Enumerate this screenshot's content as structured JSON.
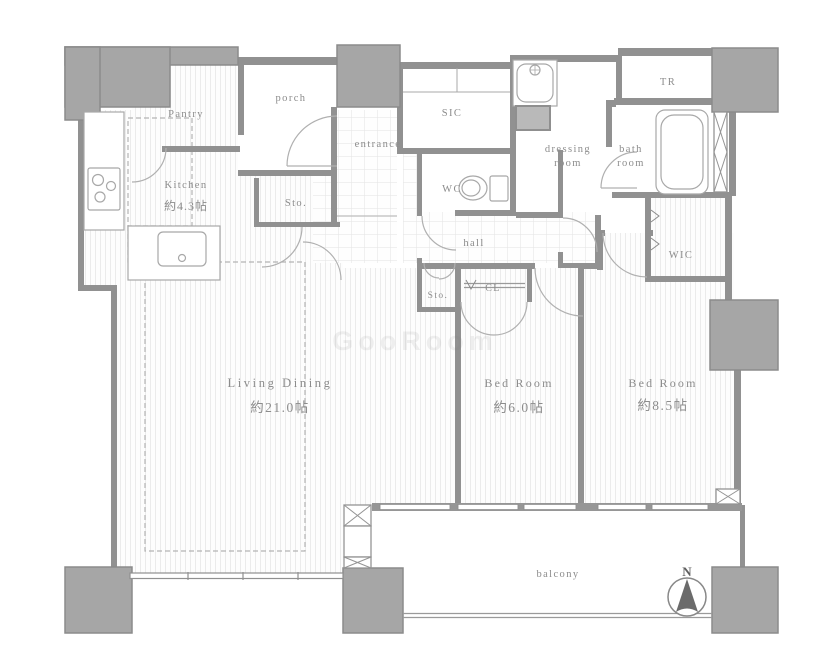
{
  "plan": {
    "rooms": {
      "pantry": {
        "label": "Pantry"
      },
      "porch": {
        "label": "porch"
      },
      "kitchen": {
        "label": "Kitchen",
        "area": "約4.3帖"
      },
      "sic": {
        "label": "SIC"
      },
      "entrance": {
        "label": "entrance"
      },
      "wc": {
        "label": "WC"
      },
      "dressing": {
        "l1": "dressing",
        "l2": "room"
      },
      "bath": {
        "l1": "bath",
        "l2": "room"
      },
      "tr": {
        "label": "TR"
      },
      "wic": {
        "label": "WIC"
      },
      "hall": {
        "label": "hall"
      },
      "sto_upper": {
        "label": "Sto."
      },
      "sto_lower": {
        "label": "Sto."
      },
      "cl": {
        "label": "CL"
      },
      "living": {
        "label": "Living Dining",
        "area": "約21.0帖"
      },
      "bed6": {
        "label": "Bed Room",
        "area": "約6.0帖"
      },
      "bed85": {
        "label": "Bed Room",
        "area": "約8.5帖"
      },
      "balcony": {
        "label": "balcony"
      }
    },
    "compass": {
      "label": "N"
    },
    "watermark": "GooRoom",
    "colors": {
      "wall": "#919191",
      "pillar": "#a6a6a6",
      "fixture_line": "#a8a8a8",
      "floor_hatch": "#ebebeb",
      "tile_line": "#e3e3e3",
      "label_text": "#8c8c8c"
    }
  }
}
